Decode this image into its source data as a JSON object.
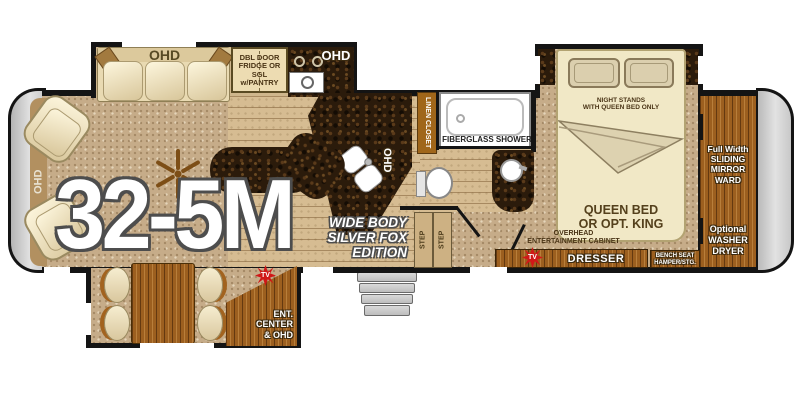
{
  "model": "32-5M",
  "edition": "WIDE BODY\nSILVER FOX\nEDITION",
  "labels": {
    "front_ohd": "OHD",
    "sofa_ohd": "OHD",
    "fridge": "DBL DOOR\nFRIDGE OR\nSGL w/PANTRY",
    "range_ohd": "OHD",
    "sink_ohd": "OHD",
    "linen_closet": "LINEN CLOSET",
    "shower": "FIBERGLASS SHOWER",
    "step_left": "STEP",
    "step_right": "STEP",
    "night_stands": "NIGHT STANDS\nWITH QUEEN BED ONLY",
    "queen_bed": "QUEEN BED\nOR OPT. KING",
    "wardrobe": "Full Width\nSLIDING\nMIRROR\nWARD",
    "washer_dryer": "Optional\nWASHER\nDRYER",
    "overhead_cabinet": "OVERHEAD\nENTERTAINMENT CABINET",
    "dresser": "DRESSER",
    "bench_seat": "BENCH SEAT\nHAMPER/STG.",
    "ent_center": "ENT.\nCENTER\n& OHD",
    "tv_living": "TV",
    "tv_bedroom": "TV"
  },
  "colors": {
    "wall": "#141414",
    "carpet_tan": "#c6ac89",
    "wood_floor": "#d6bc92",
    "cabinet_wood": "#9c5f1f",
    "counter_granite": "#2b1b0b",
    "upholstery_cream": "#efe4c2",
    "linen_amber": "#a0661a",
    "tv_star_red": "#d01818",
    "cap_gray": "#cccccc"
  }
}
